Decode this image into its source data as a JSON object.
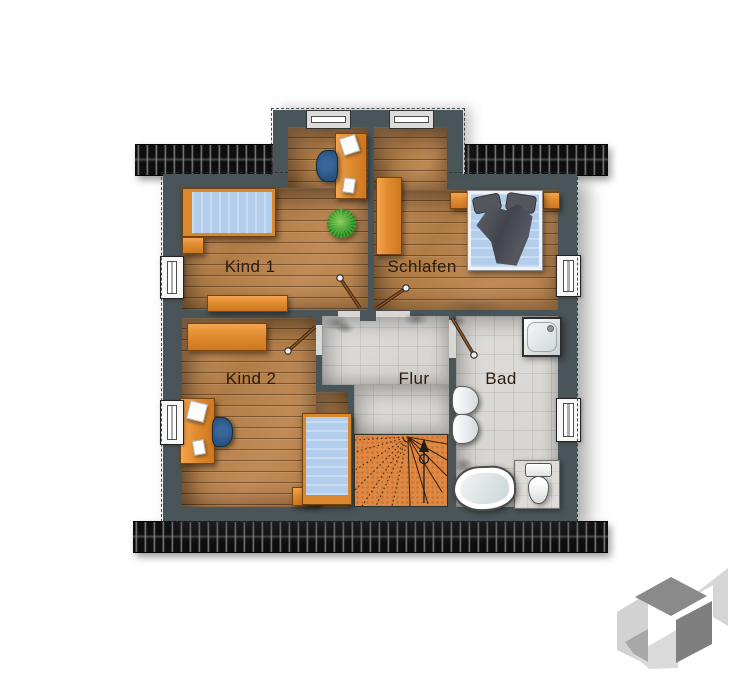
{
  "meta": {
    "kind": "floor-plan",
    "language": "de",
    "floor": "upper"
  },
  "rooms": [
    {
      "id": "kind1",
      "label": "Kind 1",
      "floor": "wood"
    },
    {
      "id": "schlafen",
      "label": "Schlafen",
      "floor": "wood"
    },
    {
      "id": "kind2",
      "label": "Kind 2",
      "floor": "wood"
    },
    {
      "id": "flur",
      "label": "Flur",
      "floor": "tile"
    },
    {
      "id": "bad",
      "label": "Bad",
      "floor": "tile"
    }
  ],
  "colors": {
    "background": "#ffffff",
    "wall": "#4a5559",
    "wood_floor": "#b9854f",
    "tile_floor": "#d8d7d3",
    "stair": "#df8843",
    "furniture_orange": "#e08c30",
    "mattress_blue": "#b3cdec",
    "chair_blue": "#2d5a88",
    "plant_green": "#3fa52e",
    "roof_strip": "#161616",
    "label_text": "#2b1b10"
  },
  "furniture": {
    "kind1": [
      "single-bed",
      "nightstand",
      "sideboard",
      "desk",
      "desk-chair",
      "papers",
      "plant"
    ],
    "schlafen": [
      "wardrobe",
      "double-bed",
      "nightstand-left",
      "nightstand-right"
    ],
    "kind2": [
      "sideboard",
      "desk",
      "desk-chair",
      "papers",
      "single-bed",
      "bench"
    ],
    "flur": [
      "winder-staircase"
    ],
    "bad": [
      "shower",
      "washbasin",
      "washbasin",
      "bathtub",
      "toilet"
    ]
  },
  "openings": {
    "windows": 6,
    "doors": 4
  },
  "watermark": {
    "name": "3d-cube-logo"
  }
}
